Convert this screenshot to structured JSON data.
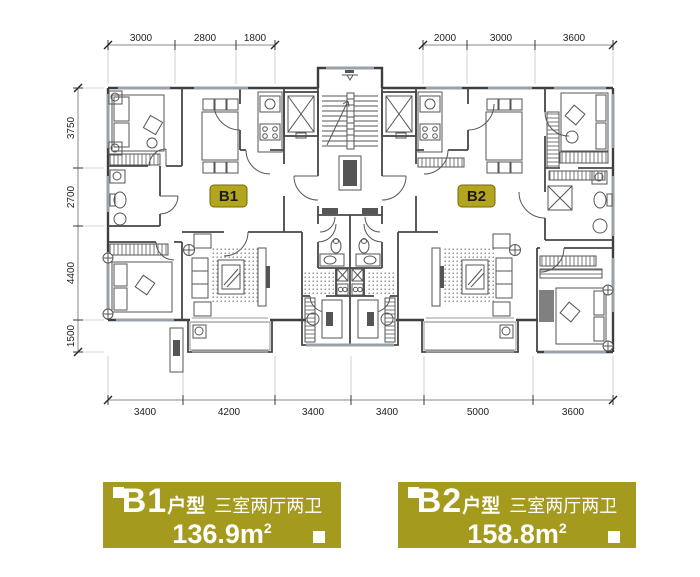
{
  "plan": {
    "unit_tags": [
      {
        "label": "B1"
      },
      {
        "label": "B2"
      }
    ]
  },
  "dimensions": {
    "top_left": [
      "3000",
      "2800",
      "1800"
    ],
    "top_right": [
      "2000",
      "3000",
      "3600"
    ],
    "left": [
      "3750",
      "2700",
      "4400",
      "1500"
    ],
    "bottom": [
      "3400",
      "4200",
      "3400",
      "3400",
      "5000",
      "3600"
    ]
  },
  "cards": [
    {
      "unit": "B1",
      "suffix": "户型",
      "rooms": "三室两厅两卫",
      "area": "136.9",
      "unit_symbol": "m",
      "exponent": "2"
    },
    {
      "unit": "B2",
      "suffix": "户型",
      "rooms": "三室两厅两卫",
      "area": "158.8",
      "unit_symbol": "m",
      "exponent": "2"
    }
  ],
  "colors": {
    "page_background": "#ffffff",
    "card_background": "#a49a1e",
    "card_text": "#ffffff",
    "tag_background": "#b3a51d",
    "tag_border": "#77690e",
    "tag_text": "#1c1c1c",
    "wall": "#3e3e3e",
    "window": "#98a2a8"
  }
}
